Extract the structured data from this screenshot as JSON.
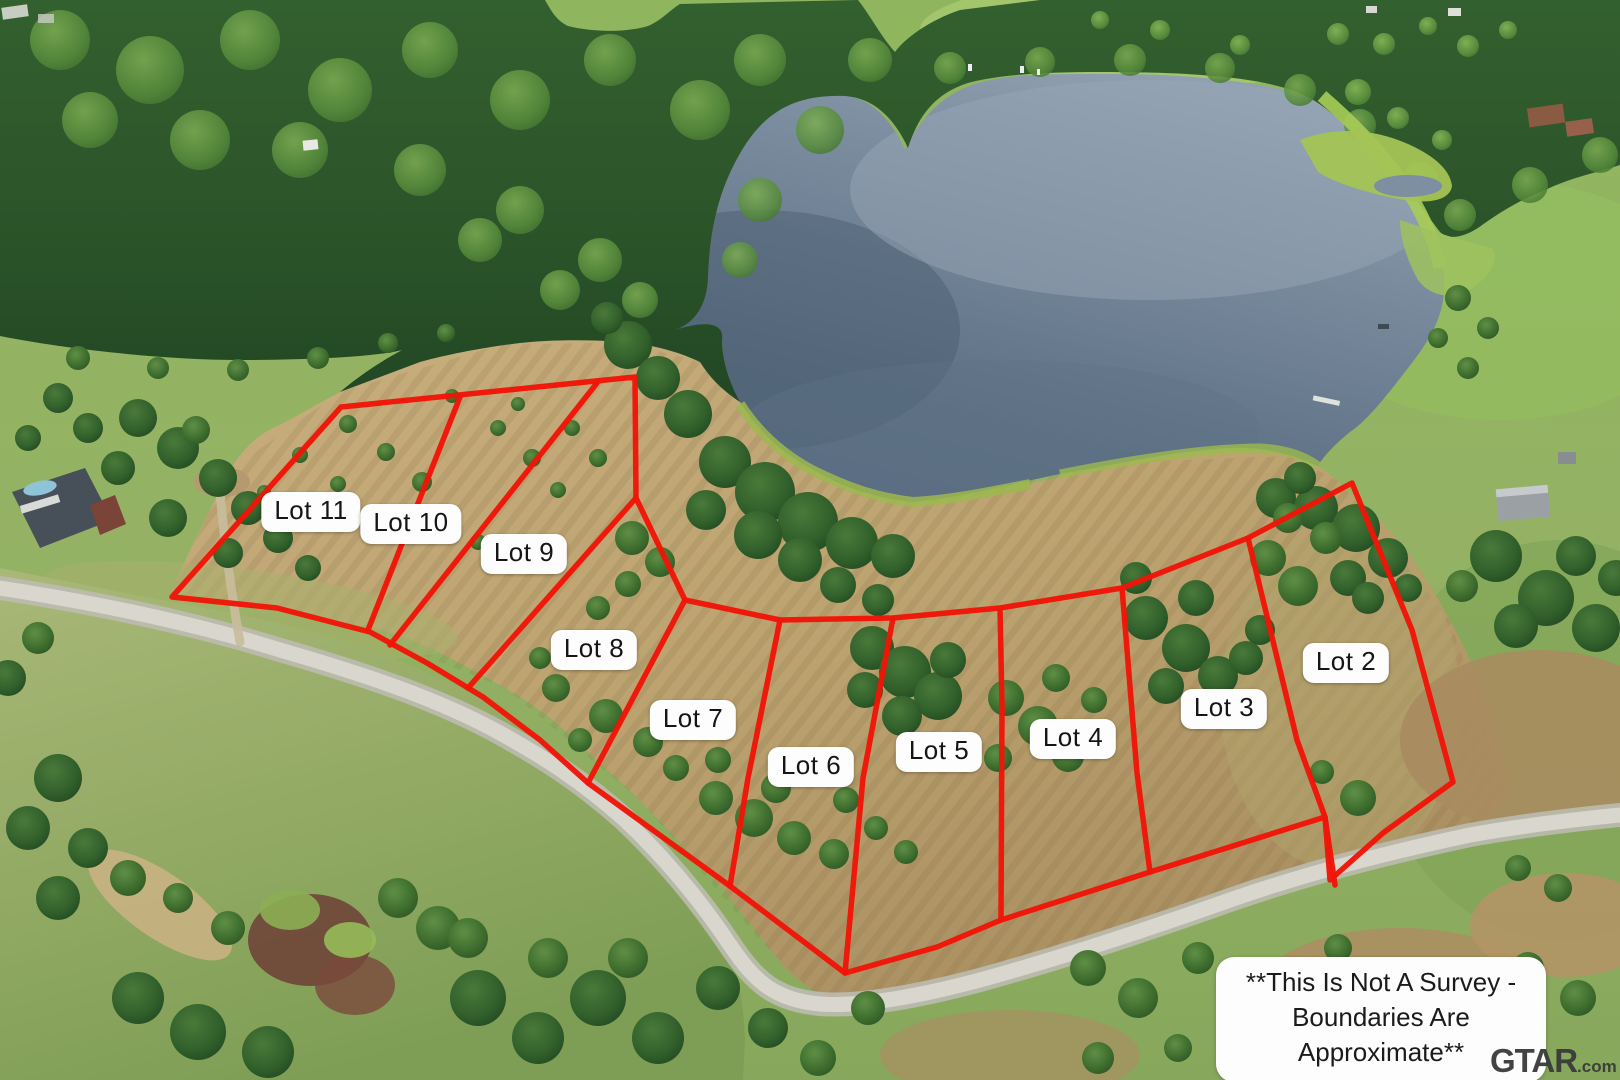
{
  "map": {
    "boundary_color": "#f11508",
    "lot_labels": [
      {
        "id": "lot-11",
        "label": "Lot 11",
        "x": 311,
        "y": 512
      },
      {
        "id": "lot-10",
        "label": "Lot 10",
        "x": 411,
        "y": 524
      },
      {
        "id": "lot-9",
        "label": "Lot 9",
        "x": 524,
        "y": 554
      },
      {
        "id": "lot-8",
        "label": "Lot 8",
        "x": 594,
        "y": 650
      },
      {
        "id": "lot-7",
        "label": "Lot 7",
        "x": 693,
        "y": 720
      },
      {
        "id": "lot-6",
        "label": "Lot 6",
        "x": 811,
        "y": 767
      },
      {
        "id": "lot-5",
        "label": "Lot 5",
        "x": 939,
        "y": 752
      },
      {
        "id": "lot-4",
        "label": "Lot 4",
        "x": 1073,
        "y": 739
      },
      {
        "id": "lot-3",
        "label": "Lot 3",
        "x": 1224,
        "y": 709
      },
      {
        "id": "lot-2",
        "label": "Lot 2",
        "x": 1346,
        "y": 663
      }
    ],
    "outer_boundary": [
      [
        172,
        597
      ],
      [
        341,
        407
      ],
      [
        635,
        377
      ],
      [
        636,
        498
      ],
      [
        685,
        600
      ],
      [
        780,
        620
      ],
      [
        893,
        618
      ],
      [
        1000,
        608
      ],
      [
        1122,
        588
      ],
      [
        1248,
        538
      ],
      [
        1352,
        483
      ],
      [
        1412,
        630
      ],
      [
        1453,
        782
      ],
      [
        1383,
        833
      ],
      [
        1330,
        880
      ],
      [
        1325,
        817
      ],
      [
        1150,
        872
      ],
      [
        1001,
        920
      ],
      [
        937,
        947
      ],
      [
        845,
        973
      ],
      [
        730,
        886
      ],
      [
        588,
        783
      ],
      [
        540,
        740
      ],
      [
        483,
        697
      ],
      [
        427,
        663
      ],
      [
        370,
        632
      ],
      [
        277,
        608
      ]
    ],
    "divider_lines": [
      {
        "between": "lot-11-lot-10",
        "points": [
          [
            460,
            397
          ],
          [
            368,
            630
          ]
        ]
      },
      {
        "between": "lot-10-lot-9",
        "points": [
          [
            597,
            383
          ],
          [
            390,
            645
          ]
        ]
      },
      {
        "between": "lot-9-lot-8",
        "points": [
          [
            636,
            498
          ],
          [
            468,
            688
          ]
        ]
      },
      {
        "between": "lot-8-lot-7",
        "points": [
          [
            685,
            600
          ],
          [
            588,
            783
          ]
        ]
      },
      {
        "between": "lot-7-lot-6",
        "points": [
          [
            780,
            620
          ],
          [
            748,
            778
          ],
          [
            730,
            886
          ]
        ]
      },
      {
        "between": "lot-6-lot-5",
        "points": [
          [
            893,
            618
          ],
          [
            863,
            778
          ],
          [
            845,
            973
          ]
        ]
      },
      {
        "between": "lot-5-lot-4",
        "points": [
          [
            1000,
            608
          ],
          [
            1002,
            707
          ],
          [
            1001,
            920
          ]
        ]
      },
      {
        "between": "lot-4-lot-3",
        "points": [
          [
            1122,
            588
          ],
          [
            1137,
            773
          ],
          [
            1150,
            872
          ]
        ]
      },
      {
        "between": "lot-3-lot-2",
        "points": [
          [
            1248,
            538
          ],
          [
            1297,
            740
          ],
          [
            1325,
            817
          ],
          [
            1335,
            885
          ]
        ]
      }
    ]
  },
  "disclaimer": {
    "line1": "**This Is Not A Survey -",
    "line2": "Boundaries Are Approximate**"
  },
  "watermark": {
    "brand": "GTAR",
    "suffix": ".com"
  }
}
